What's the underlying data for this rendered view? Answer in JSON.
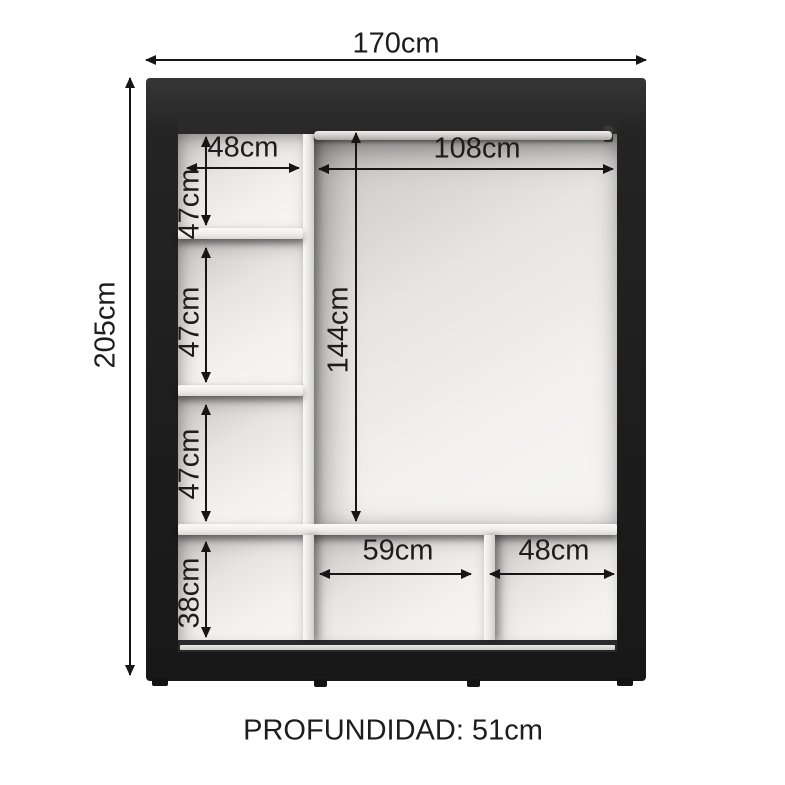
{
  "diagram": {
    "overall": {
      "width": "170cm",
      "height": "205cm",
      "depth": "PROFUNDIDAD: 51cm"
    },
    "left_column": {
      "shelf_width": "48cm",
      "compartment_1_height": "47cm",
      "compartment_2_height": "47cm",
      "compartment_3_height": "47cm",
      "bottom_compartment_height": "38cm"
    },
    "hanging_section": {
      "rod_width": "108cm",
      "hanging_height": "144cm"
    },
    "bottom_row": {
      "middle_compartment_width": "59cm",
      "right_compartment_width": "48cm"
    },
    "colors": {
      "frame": "#232323",
      "interior_shadow": "#2a2a2a",
      "panel": "#f2f1ee",
      "dimension_line": "#161616",
      "background": "#ffffff"
    }
  }
}
